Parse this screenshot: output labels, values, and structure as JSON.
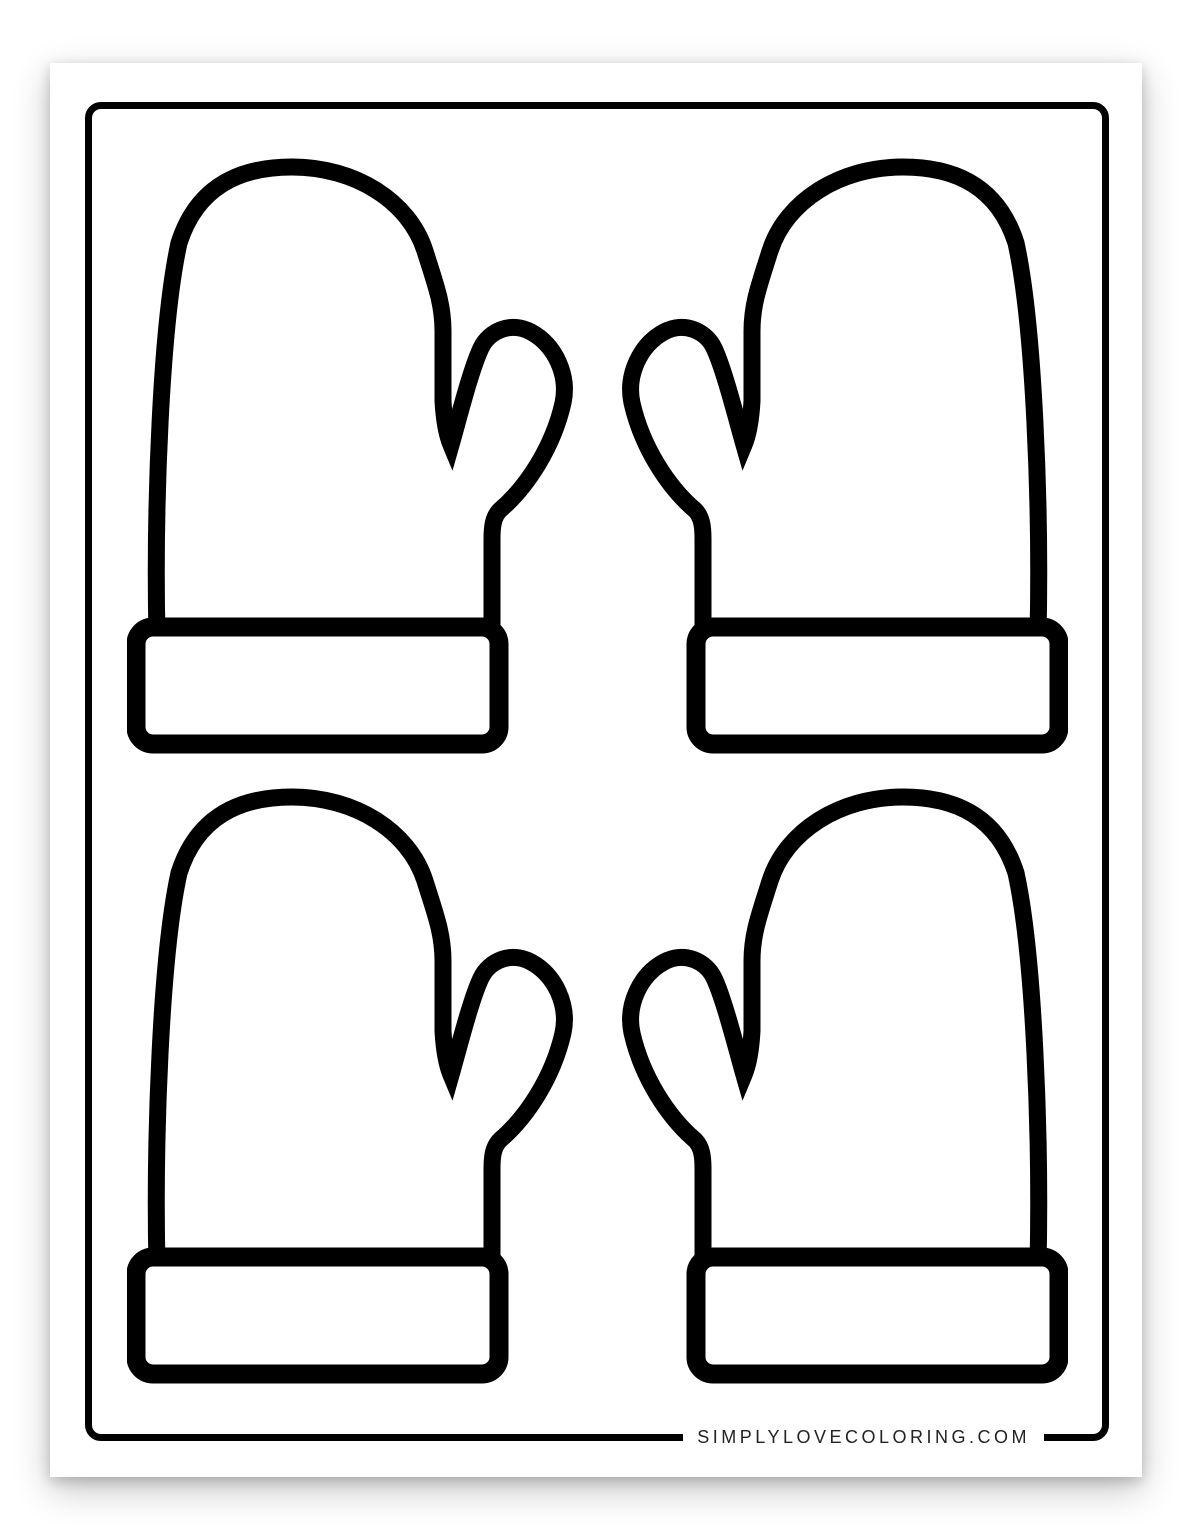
{
  "page": {
    "footer": {
      "website": "SIMPLYLOVECOLORING.COM"
    },
    "colors": {
      "paper": "#ffffff",
      "line": "#000000",
      "footer_text": "#222222"
    }
  },
  "artwork": {
    "description": "Blank mitten outlines coloring page, 2x2 grid, inner mittens mirrored to face each other",
    "mittens": [
      {
        "id": "mitten-top-left",
        "hand": "left",
        "row": 1,
        "col": 1
      },
      {
        "id": "mitten-top-right",
        "hand": "right",
        "row": 1,
        "col": 2
      },
      {
        "id": "mitten-bottom-left",
        "hand": "left",
        "row": 2,
        "col": 1
      },
      {
        "id": "mitten-bottom-right",
        "hand": "right",
        "row": 2,
        "col": 2
      }
    ]
  }
}
